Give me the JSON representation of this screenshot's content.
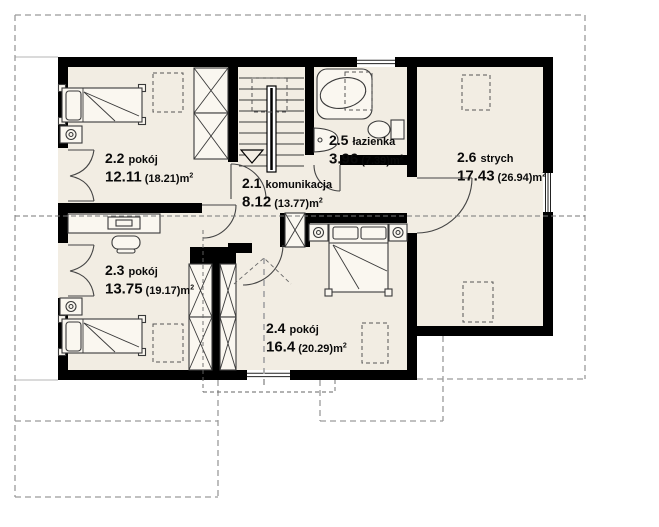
{
  "plan": {
    "unit_base": "m",
    "unit_sup": "2",
    "rooms": [
      {
        "number": "2.1",
        "name": "komunikacja",
        "area": "8.12",
        "gross": "(13.77)"
      },
      {
        "number": "2.2",
        "name": "pokój",
        "area": "12.11",
        "gross": "(18.21)"
      },
      {
        "number": "2.3",
        "name": "pokój",
        "area": "13.75",
        "gross": "(19.17)"
      },
      {
        "number": "2.4",
        "name": "pokój",
        "area": "16.4",
        "gross": "(20.29)"
      },
      {
        "number": "2.5",
        "name": "łazienka",
        "area": "3.96",
        "gross": "(7.39)"
      },
      {
        "number": "2.6",
        "name": "strych",
        "area": "17.43",
        "gross": "(26.94)"
      }
    ],
    "colors": {
      "wall": "#000000",
      "floor": "#f2ede3",
      "furniture_fill": "#faf7f0",
      "line": "#3a3a3a",
      "dashed_gray": "#9a9a9a",
      "text": "#0a0a0a",
      "background": "#ffffff"
    }
  }
}
